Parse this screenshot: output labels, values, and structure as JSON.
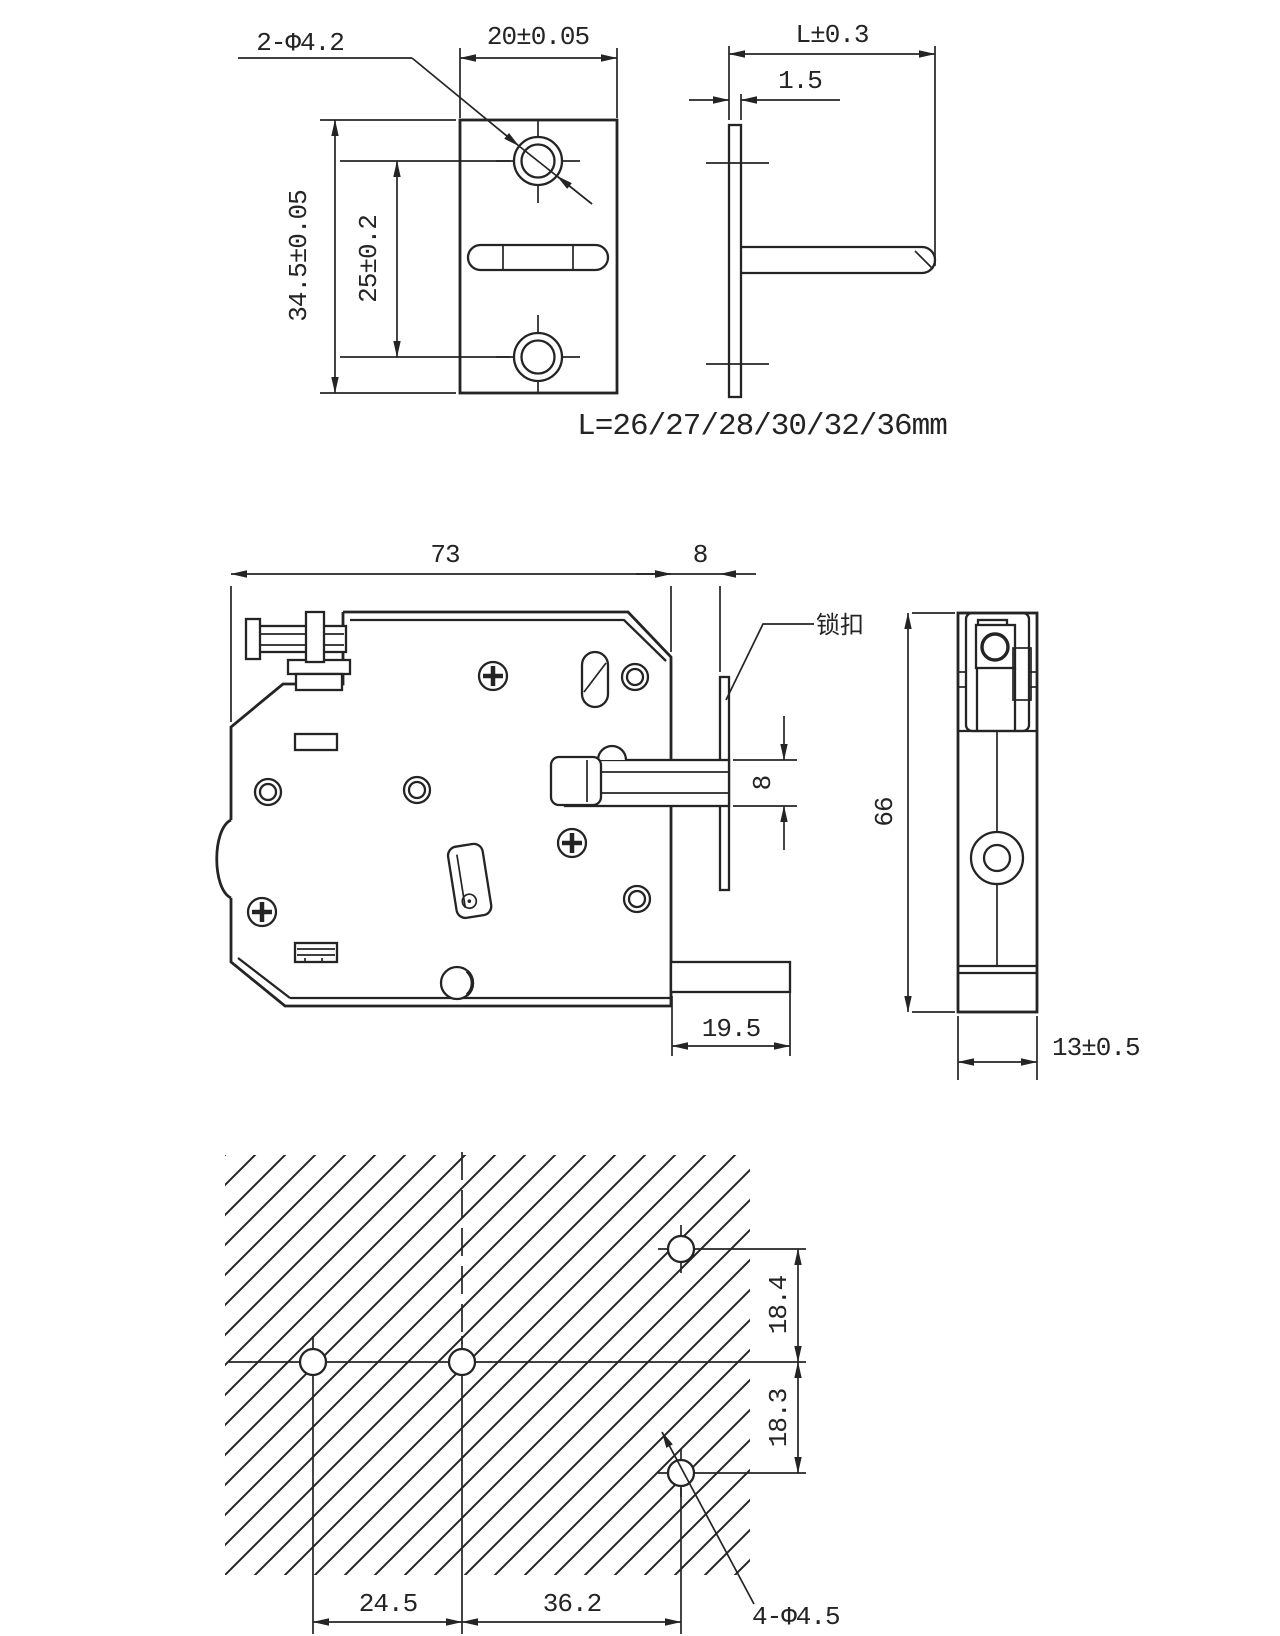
{
  "drawing": {
    "plate_front": {
      "hole_callout": "2-Φ4.2",
      "width": "20±0.05",
      "height": "34.5±0.05",
      "hole_spacing": "25±0.2"
    },
    "plate_side": {
      "length": "L±0.3",
      "thickness": "1.5",
      "length_note": "L=26/27/28/30/32/36mm"
    },
    "lock_front": {
      "body_width": "73",
      "plate_gap": "8",
      "catch_label": "锁扣",
      "bolt_height": "8",
      "foot_length": "19.5"
    },
    "lock_side": {
      "body_height": "66",
      "body_depth": "13±0.5"
    },
    "mount_pattern": {
      "upper_hole_offset": "18.4",
      "lower_hole_offset": "18.3",
      "hole_spacing_left": "24.5",
      "hole_spacing_right": "36.2",
      "hole_callout": "4-Φ4.5"
    },
    "colors": {
      "line": "#242424",
      "background": "#ffffff"
    }
  }
}
